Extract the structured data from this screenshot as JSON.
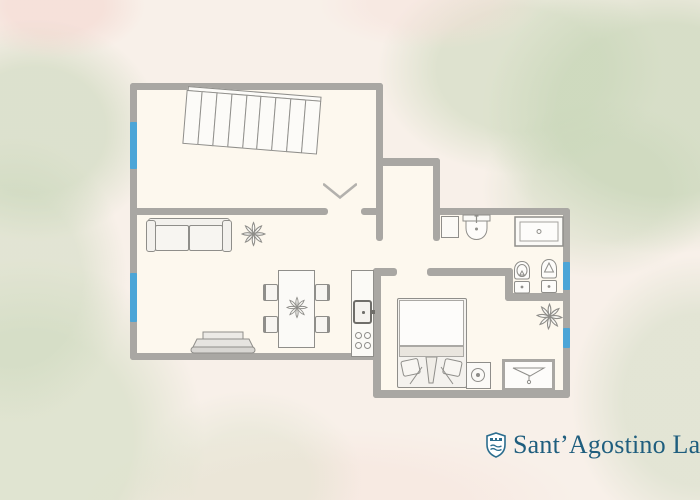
{
  "brand": {
    "name": "Sant’Agostino Lak",
    "icon": "shield-lake-icon"
  },
  "colors": {
    "wall": "#a9a7a3",
    "window": "#4ba5d7",
    "outline": "#8f8e8a",
    "floor": "#fdf8ee",
    "background": "#f8f0e9",
    "brand_text": "#1f5e7e",
    "brand_icon": "#2b6d8e",
    "watercolor_green": "#c9d9bf",
    "watercolor_pink": "#f3d2cb"
  },
  "floorplan": {
    "type": "apartment-floor-plan",
    "staircase": {
      "steps": 9
    },
    "windows": [
      "left-upper-room",
      "left-living-room",
      "right-bathroom",
      "right-bedroom-area"
    ],
    "door_openings": 4,
    "fixtures": [
      "staircase",
      "sofa",
      "plant",
      "tv-stand",
      "dining-table",
      "dining-chair",
      "dining-chair",
      "dining-chair",
      "dining-chair",
      "table-plant",
      "kitchen-counter",
      "kitchen-sink",
      "stove-4-burners",
      "double-bed",
      "washing-machine",
      "shower-column",
      "washbasin",
      "vanity-sink",
      "toilet",
      "bidet",
      "bathroom-plant",
      "laundry-basin"
    ]
  }
}
